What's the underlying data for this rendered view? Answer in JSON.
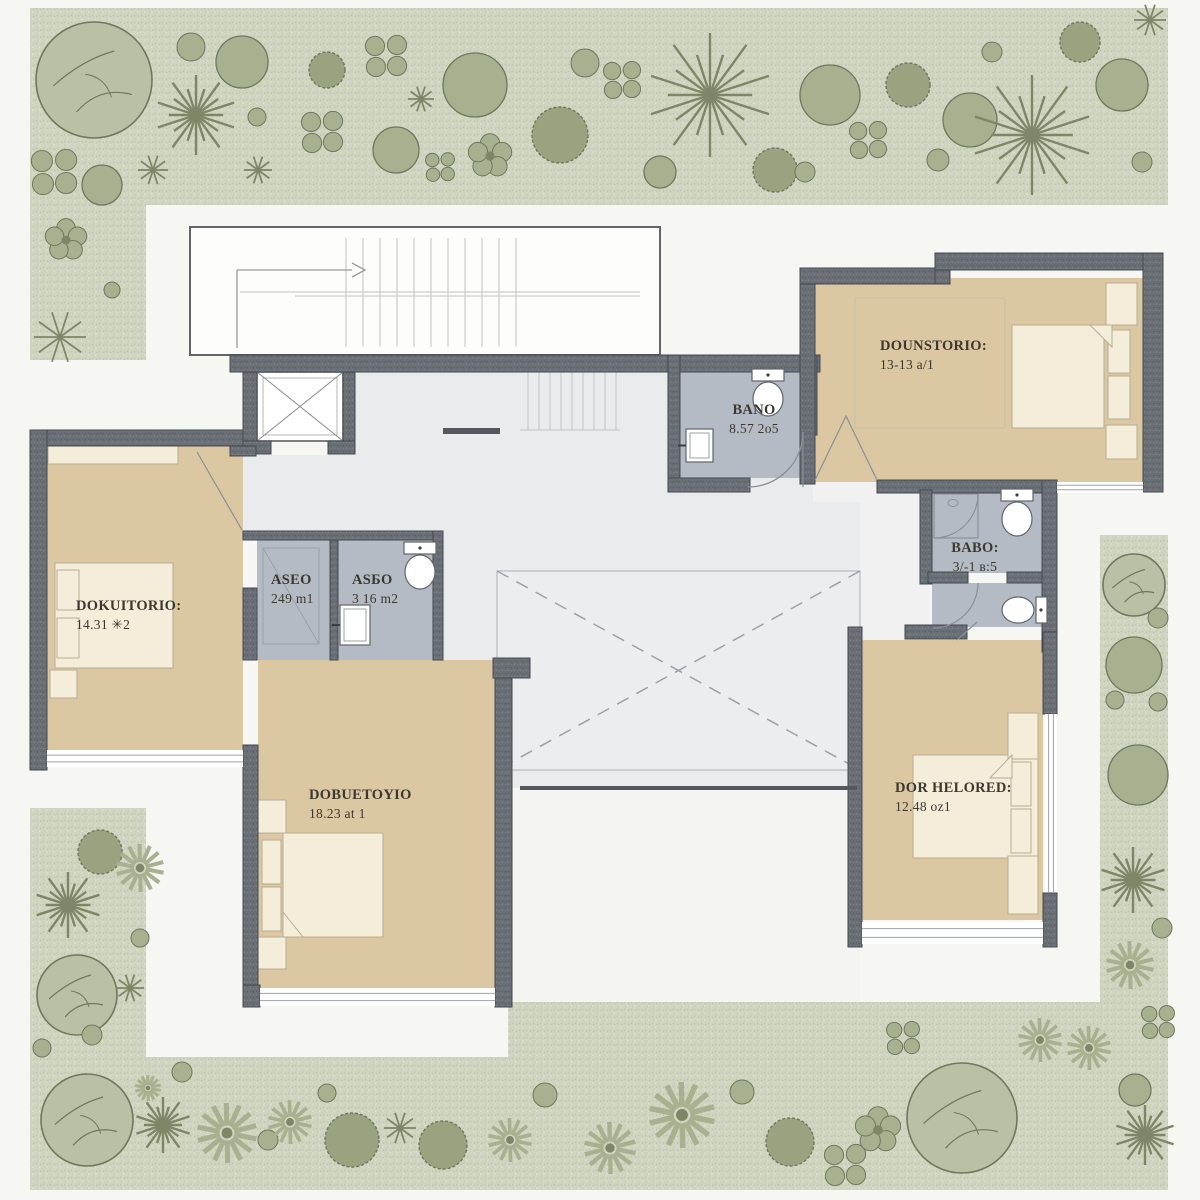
{
  "plan": {
    "title": "upper floor plan with garden",
    "rooms": [
      {
        "key": "dormitorio_top_right",
        "label": "DOUNSTORIO:",
        "area": "13-13 a/1"
      },
      {
        "key": "bano_top",
        "label": "BANO",
        "area": "8.57 2o5"
      },
      {
        "key": "aseo",
        "label": "ASEO",
        "area": "249 m1"
      },
      {
        "key": "aseo2",
        "label": "ASБO",
        "area": "3 16 m2"
      },
      {
        "key": "dormitorio_left",
        "label": "DOKUITORIO:",
        "area": "14.31 ✳2"
      },
      {
        "key": "dormitorio_bottom",
        "label": "DOBUETOYIO",
        "area": "18.23 at 1"
      },
      {
        "key": "bano_right",
        "label": "BABO:",
        "area": "3/-1 в:5"
      },
      {
        "key": "dormitorio_bottom_right",
        "label": "DOR HELORED:",
        "area": "12.48 oz1"
      }
    ],
    "colors": {
      "background": "#f6f6f2",
      "garden": "#cfd5c1",
      "garden_speck_dark": "#bec6ad",
      "garden_speck_light": "#dde2d0",
      "plant_light": "#b9c0a6",
      "plant_mid": "#a7b08f",
      "plant_dark": "#99a37f",
      "plant_stroke": "#6e785c",
      "wall": "#6a6f76",
      "wall_stroke": "#44484e",
      "bedroom_floor": "#dbc7a2",
      "bath_floor": "#b4bbc4",
      "hall_floor": "#e9ebed",
      "corridor_floor": "#f1f1f2",
      "terrace_floor": "#f4f4f2",
      "court_floor": "#ecedef",
      "furniture": "#f4edda",
      "furniture_stroke": "#b7ad92",
      "fixture_stroke": "#60656c",
      "line_gray": "#c3c3c6",
      "door_stroke": "#8a9097",
      "text": "#3d382f"
    }
  }
}
